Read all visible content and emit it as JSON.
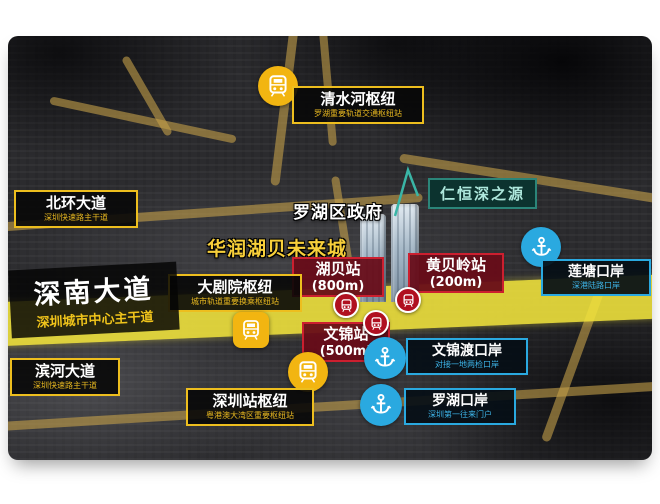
{
  "map": {
    "road_labels": {
      "qingshuihe": {
        "title": "清水河枢纽",
        "subtitle": "罗湖重要轨道交通枢纽站"
      },
      "beihuan": {
        "title": "北环大道",
        "subtitle": "深圳快速路主干道"
      },
      "theater": {
        "title": "大剧院枢纽",
        "subtitle": "城市轨道重要换乘枢纽站"
      },
      "shennan": {
        "title": "深南大道",
        "subtitle": "深圳城市中心主干道"
      },
      "binhe": {
        "title": "滨河大道",
        "subtitle": "深圳快速路主干道"
      },
      "shenzhen_station": {
        "title": "深圳站枢纽",
        "subtitle": "粤港澳大湾区重要枢纽站"
      }
    },
    "metro_stations": {
      "hubei": {
        "name": "湖贝站",
        "distance": "(800m)"
      },
      "huangbeiling": {
        "name": "黄贝岭站",
        "distance": "(200m)"
      },
      "wenjin": {
        "name": "文锦站",
        "distance": "(500m)"
      }
    },
    "ports": {
      "wenjindu": {
        "title": "文锦渡口岸",
        "subtitle": "对接一地两检口岸"
      },
      "liantang": {
        "title": "莲塘口岸",
        "subtitle": "深港陆路口岸"
      },
      "luohu": {
        "title": "罗湖口岸",
        "subtitle": "深圳第一往来门户"
      }
    },
    "plain_labels": {
      "district_gov": "罗湖区政府",
      "future_city": "华润湖贝未来城",
      "project": "仁恒深之源"
    },
    "icons": {
      "rail_hub": "train-icon",
      "metro": "metro-train-icon",
      "port": "anchor-icon"
    },
    "colors": {
      "accent_yellow": "#edbe1e",
      "road_bright_yellow": "#f3e53c",
      "road_ochre": "#c49a4a",
      "station_red_fill": "#680c18",
      "station_red_border": "#cc1f2f",
      "metro_roundel": "#b01020",
      "port_blue": "#2aa9e0",
      "project_teal_border": "#2b8579",
      "project_teal_text": "#aee8dd",
      "label_black": "#080808"
    }
  }
}
